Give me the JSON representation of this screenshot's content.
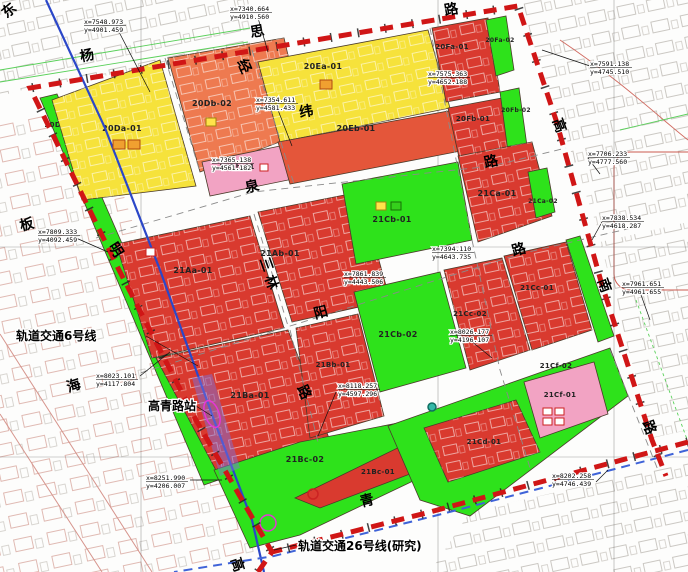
{
  "map": {
    "colors": {
      "yellow": "#f6e23b",
      "salmon": "#ee7a50",
      "redOrange": "#e4563a",
      "red": "#d93a2f",
      "green": "#2ee21b",
      "pink": "#f2a3c3",
      "boundary": "#d01616",
      "rail6": "#2b47c8",
      "rail26": "#3f63d8",
      "station": "#e635d8"
    },
    "parcels": [
      {
        "id": "20Da-02",
        "color": "green",
        "pts": "40,98 57,94 224,478 204,485",
        "lx": 62,
        "ly": 127,
        "fs": 7
      },
      {
        "id": "20Da-01",
        "color": "yellow",
        "pts": "52,100 160,60 196,186 82,200",
        "lx": 122,
        "ly": 131,
        "tex": true
      },
      {
        "id": "20Db-02",
        "color": "salmon",
        "pts": "168,58 284,38 306,132 200,172",
        "lx": 212,
        "ly": 106,
        "tex": true
      },
      {
        "id": "20Db-01",
        "color": "pink",
        "pts": "202,162 290,144 298,178 210,196",
        "lx": 237,
        "ly": 169,
        "fs": 7
      },
      {
        "id": "20Ea-01",
        "color": "yellow",
        "pts": "258,62 428,30 450,108 280,142",
        "lx": 323,
        "ly": 69,
        "tex": true
      },
      {
        "id": "20Eb-01",
        "color": "redOrange",
        "pts": "278,142 454,110 466,150 290,184",
        "lx": 356,
        "ly": 131
      },
      {
        "id": "20Fa-01",
        "color": "red",
        "pts": "432,28 488,18 500,92 446,102",
        "lx": 452,
        "ly": 49,
        "fs": 7,
        "tex": true
      },
      {
        "id": "20Fa-02",
        "color": "green",
        "pts": "486,20 506,16 514,70 496,76",
        "lx": 500,
        "ly": 42,
        "fs": 6
      },
      {
        "id": "20Fb-01",
        "color": "red",
        "pts": "448,108 502,98 512,150 460,162",
        "lx": 473,
        "ly": 121,
        "fs": 7,
        "tex": true
      },
      {
        "id": "20Fb-02",
        "color": "green",
        "pts": "500,92 519,88 527,146 508,152",
        "lx": 516,
        "ly": 112,
        "fs": 6
      },
      {
        "id": "21Aa-01",
        "color": "red",
        "pts": "116,244 250,216 284,328 152,358",
        "lx": 193,
        "ly": 273,
        "tex": true
      },
      {
        "id": "21Ab-01",
        "color": "red",
        "pts": "258,212 360,192 390,300 292,322",
        "lx": 280,
        "ly": 256,
        "tex": true
      },
      {
        "id": "21Cb-01",
        "color": "green",
        "pts": "342,184 458,162 472,240 356,264",
        "lx": 392,
        "ly": 222
      },
      {
        "id": "21Ca-01",
        "color": "red",
        "pts": "458,156 532,142 552,216 478,242",
        "lx": 497,
        "ly": 196,
        "tex": true
      },
      {
        "id": "21Ca-02",
        "color": "green",
        "pts": "528,172 547,168 555,212 536,218",
        "lx": 543,
        "ly": 203,
        "fs": 6
      },
      {
        "id": "21Ba-01",
        "color": "red",
        "pts": "156,358 288,330 332,446 218,474",
        "lx": 250,
        "ly": 398,
        "tex": true
      },
      {
        "id": "21Bb-01",
        "color": "red",
        "pts": "296,328 358,314 384,416 310,438",
        "lx": 333,
        "ly": 367,
        "fs": 7,
        "tex": true
      },
      {
        "id": "21Cb-02",
        "color": "green",
        "pts": "354,292 440,272 466,368 380,392",
        "lx": 398,
        "ly": 337
      },
      {
        "id": "21Cc-02",
        "color": "red",
        "pts": "444,270 502,258 530,350 470,370",
        "lx": 470,
        "ly": 316,
        "fs": 7,
        "tex": true
      },
      {
        "id": "21Cc-01",
        "color": "red",
        "pts": "504,256 566,242 592,330 532,350",
        "lx": 537,
        "ly": 290,
        "fs": 7,
        "tex": true
      },
      {
        "id": "21Cg-02",
        "color": "green",
        "pts": "566,240 580,236 614,336 598,342",
        "lx": null,
        "ly": null
      },
      {
        "id": "21Bc-02",
        "color": "green",
        "pts": "214,470 300,442 465,410 478,450 300,535 250,548",
        "lx": 305,
        "ly": 462
      },
      {
        "id": "21Bc-01",
        "color": "red",
        "pts": "295,498 455,420 468,452 320,508",
        "lx": 378,
        "ly": 474,
        "fs": 7
      },
      {
        "id": "21Ce-02",
        "color": "green",
        "pts": "388,426 610,348 628,396 470,516 420,500",
        "lx": 450,
        "ly": 440
      },
      {
        "id": "21Cd-01",
        "color": "red",
        "pts": "424,428 516,400 540,452 448,482",
        "lx": 484,
        "ly": 444,
        "fs": 7,
        "tex": true
      },
      {
        "id": "21Cf-01",
        "color": "pink",
        "pts": "524,382 594,362 608,414 540,438",
        "lx": 560,
        "ly": 397,
        "fs": 7
      }
    ],
    "extra_labels": [
      {
        "text": "21Cf-02",
        "x": 556,
        "y": 368,
        "fs": 7
      }
    ],
    "road_chars": [
      {
        "ch": "东",
        "x": 12,
        "y": 14,
        "rot": -40
      },
      {
        "ch": "杨",
        "x": 88,
        "y": 60,
        "rot": -12
      },
      {
        "ch": "思",
        "x": 258,
        "y": 36,
        "rot": -10
      },
      {
        "ch": "路",
        "x": 452,
        "y": 14,
        "rot": -10
      },
      {
        "ch": "经",
        "x": 240,
        "y": 68,
        "rot": 66
      },
      {
        "ch": "纬",
        "x": 307,
        "y": 116,
        "rot": -10
      },
      {
        "ch": "泉",
        "x": 253,
        "y": 191,
        "rot": -12
      },
      {
        "ch": "路",
        "x": 492,
        "y": 166,
        "rot": -12
      },
      {
        "ch": "板",
        "x": 28,
        "y": 229,
        "rot": -15
      },
      {
        "ch": "明",
        "x": 112,
        "y": 252,
        "rot": 58
      },
      {
        "ch": "三",
        "x": 262,
        "y": 266,
        "rot": 70
      },
      {
        "ch": "林",
        "x": 267,
        "y": 284,
        "rot": 70
      },
      {
        "ch": "阳",
        "x": 322,
        "y": 317,
        "rot": -15
      },
      {
        "ch": "路",
        "x": 520,
        "y": 254,
        "rot": -15
      },
      {
        "ch": "海",
        "x": 75,
        "y": 390,
        "rot": -18
      },
      {
        "ch": "路",
        "x": 300,
        "y": 394,
        "rot": 66
      },
      {
        "ch": "高",
        "x": 555,
        "y": 127,
        "rot": 70
      },
      {
        "ch": "南",
        "x": 600,
        "y": 287,
        "rot": 70
      },
      {
        "ch": "路",
        "x": 645,
        "y": 429,
        "rot": 70
      },
      {
        "ch": "高",
        "x": 233,
        "y": 566,
        "rot": 72
      },
      {
        "ch": "青",
        "x": 368,
        "y": 505,
        "rot": -14
      }
    ],
    "coords": [
      {
        "l1": "x=7548.973",
        "l2": "y=4901.459",
        "x": 84,
        "y": 18,
        "lead": [
          118,
          30,
          150,
          92
        ]
      },
      {
        "l1": "x=7340.664",
        "l2": "y=4910.560",
        "x": 230,
        "y": 5,
        "lead": [
          258,
          18,
          268,
          52
        ]
      },
      {
        "l1": "x=7354.611",
        "l2": "y=4581.433",
        "x": 256,
        "y": 96,
        "lead": [
          278,
          110,
          292,
          146
        ]
      },
      {
        "l1": "x=7365.138",
        "l2": "y=4561.182",
        "x": 212,
        "y": 156,
        "lead": null
      },
      {
        "l1": "x=7575.363",
        "l2": "y=4652.188",
        "x": 428,
        "y": 70,
        "lead": null
      },
      {
        "l1": "x=7591.138",
        "l2": "y=4745.510",
        "x": 590,
        "y": 60,
        "lead": [
          590,
          66,
          542,
          50
        ]
      },
      {
        "l1": "x=7706.233",
        "l2": "y=4777.560",
        "x": 588,
        "y": 150,
        "lead": [
          588,
          158,
          600,
          174
        ]
      },
      {
        "l1": "x=7838.534",
        "l2": "y=4618.287",
        "x": 602,
        "y": 214,
        "lead": [
          602,
          222,
          592,
          240
        ]
      },
      {
        "l1": "x=7961.651",
        "l2": "y=4961.655",
        "x": 622,
        "y": 280,
        "lead": [
          640,
          292,
          650,
          320
        ]
      },
      {
        "l1": "x=7809.333",
        "l2": "y=4092.459",
        "x": 38,
        "y": 228,
        "lead": [
          76,
          238,
          108,
          252
        ]
      },
      {
        "l1": "x=8023.101",
        "l2": "y=4117.804",
        "x": 96,
        "y": 372,
        "lead": [
          140,
          376,
          170,
          352
        ]
      },
      {
        "l1": "x=8251.990",
        "l2": "y=4206.007",
        "x": 146,
        "y": 474,
        "lead": [
          190,
          480,
          222,
          480
        ]
      },
      {
        "l1": "x=8118.257",
        "l2": "y=4597.296",
        "x": 338,
        "y": 382,
        "lead": [
          336,
          392,
          318,
          436
        ]
      },
      {
        "l1": "x=8026.177",
        "l2": "y=4196.107",
        "x": 450,
        "y": 328,
        "lead": [
          470,
          340,
          492,
          358
        ]
      },
      {
        "l1": "x=8202.258",
        "l2": "y=4746.439",
        "x": 552,
        "y": 472,
        "lead": [
          596,
          482,
          608,
          470
        ]
      },
      {
        "l1": "x=7394.110",
        "l2": "y=4643.735",
        "x": 432,
        "y": 245,
        "lead": null
      },
      {
        "l1": "x=7861.839",
        "l2": "y=4443.506",
        "x": 344,
        "y": 270,
        "lead": null
      }
    ],
    "notes": [
      {
        "text": "轨道交通6号线",
        "x": 16,
        "y": 340,
        "lead": [
          146,
          336,
          198,
          366
        ]
      },
      {
        "text": "高青路站",
        "x": 148,
        "y": 410,
        "lead": [
          196,
          406,
          212,
          416
        ]
      },
      {
        "text": "轨道交通26号线(研究)",
        "x": 298,
        "y": 550,
        "lead": [
          296,
          545,
          274,
          550
        ]
      }
    ],
    "icons": [
      {
        "s": "rect",
        "x": 113,
        "y": 140,
        "w": 12,
        "h": 9,
        "f": "#f0a030",
        "st": "#b04a10"
      },
      {
        "s": "rect",
        "x": 128,
        "y": 140,
        "w": 12,
        "h": 9,
        "f": "#f0a030",
        "st": "#b04a10"
      },
      {
        "s": "rect",
        "x": 206,
        "y": 118,
        "w": 10,
        "h": 8,
        "f": "#ffe34a",
        "st": "#a08410"
      },
      {
        "s": "rect",
        "x": 260,
        "y": 164,
        "w": 8,
        "h": 7,
        "f": "#ffffff",
        "st": "#cc2222"
      },
      {
        "s": "rect",
        "x": 320,
        "y": 80,
        "w": 12,
        "h": 9,
        "f": "#f0a030",
        "st": "#b04a10"
      },
      {
        "s": "rect",
        "x": 376,
        "y": 202,
        "w": 10,
        "h": 8,
        "f": "#ffe34a",
        "st": "#a08410"
      },
      {
        "s": "rect",
        "x": 391,
        "y": 202,
        "w": 10,
        "h": 8,
        "f": "#35d01c",
        "st": "#157005"
      },
      {
        "s": "rect",
        "x": 146,
        "y": 248,
        "w": 9,
        "h": 8,
        "f": "#ffffff",
        "st": "#cc2222"
      },
      {
        "s": "circle",
        "x": 432,
        "y": 407,
        "r": 4,
        "f": "#35b8a8",
        "st": "#0e6e60"
      },
      {
        "s": "ring",
        "x": 313,
        "y": 494,
        "r": 5,
        "st": "#cc2222"
      },
      {
        "s": "rect",
        "x": 543,
        "y": 408,
        "w": 9,
        "h": 7,
        "f": "#ffffff",
        "st": "#cc2222"
      },
      {
        "s": "rect",
        "x": 555,
        "y": 408,
        "w": 9,
        "h": 7,
        "f": "#ffffff",
        "st": "#cc2222"
      },
      {
        "s": "rect",
        "x": 543,
        "y": 418,
        "w": 9,
        "h": 7,
        "f": "#ffffff",
        "st": "#cc2222"
      },
      {
        "s": "rect",
        "x": 555,
        "y": 418,
        "w": 9,
        "h": 7,
        "f": "#ffffff",
        "st": "#cc2222"
      }
    ]
  }
}
